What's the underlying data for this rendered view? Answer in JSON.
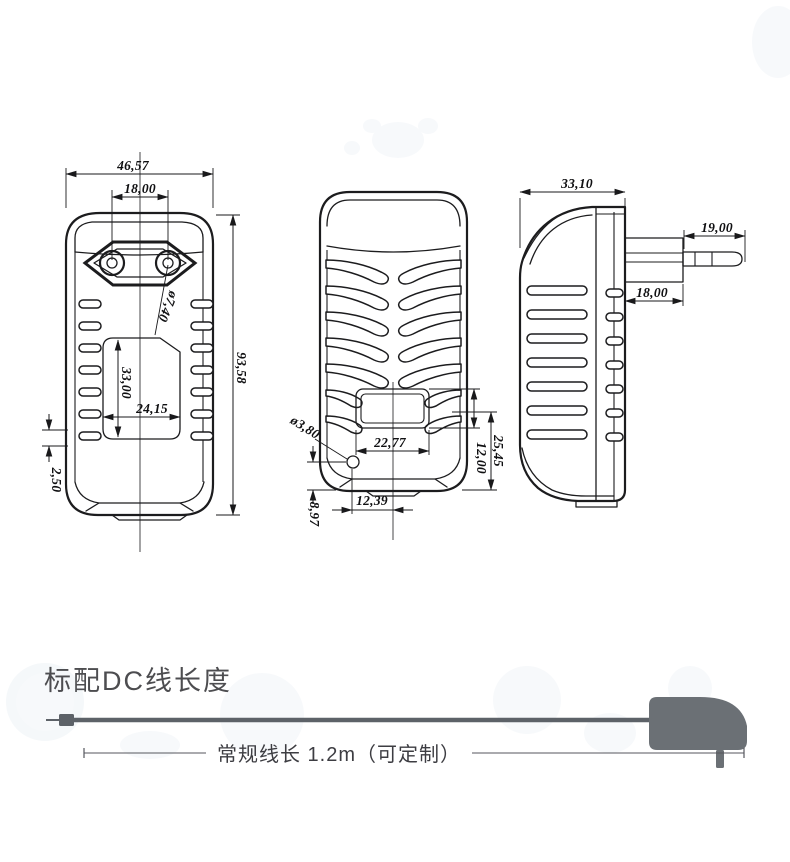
{
  "drawing": {
    "front_view": {
      "width": "46,57",
      "pin_spacing": "18,00",
      "pin_diameter": "ø7,40",
      "height": "93,58",
      "label_recess_height": "33,00",
      "label_recess_width": "24,15",
      "rib_pitch": "2,50"
    },
    "back_view": {
      "label_width": "22,77",
      "hole_diameter": "ø3,80",
      "hole_offset_from_center": "12,39",
      "hole_offset_from_bottom": "8,97",
      "label_area_to_bottom": "25,45",
      "label_height": "12,00"
    },
    "side_view": {
      "depth": "33,10",
      "plug_pin_length": "19,00",
      "plug_base_depth": "18,00"
    }
  },
  "cable_section": {
    "heading": "标配DC线长度",
    "cable_length_label": "常规线长 1.2m（可定制）"
  },
  "colors": {
    "drawing_line": "#1c1c1e",
    "heading_text": "#4d4d50",
    "cable_gray": "#5d6268",
    "plug_silhouette": "#6b7075"
  }
}
